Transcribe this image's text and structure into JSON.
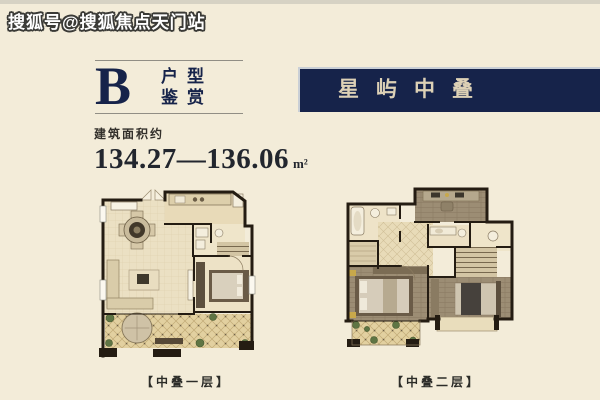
{
  "watermark": "搜狐号@搜狐焦点天门站",
  "unit_block": {
    "letter": "B",
    "label_top": "户型",
    "label_bottom": "鉴赏"
  },
  "banner": {
    "title": "星屿中叠"
  },
  "area": {
    "label": "建筑面积约",
    "value": "134.27—136.06",
    "unit": "m²"
  },
  "plan_labels": {
    "level1": "【中叠一层】",
    "level2": "【中叠二层】"
  },
  "colors": {
    "bg": "#f3ecd9",
    "top-strip": "#d6d2c4",
    "navy": "#16234a",
    "banner-text": "#ddd1b6",
    "ink": "#22262e",
    "line": "#918e85",
    "wall": "#241c12"
  }
}
